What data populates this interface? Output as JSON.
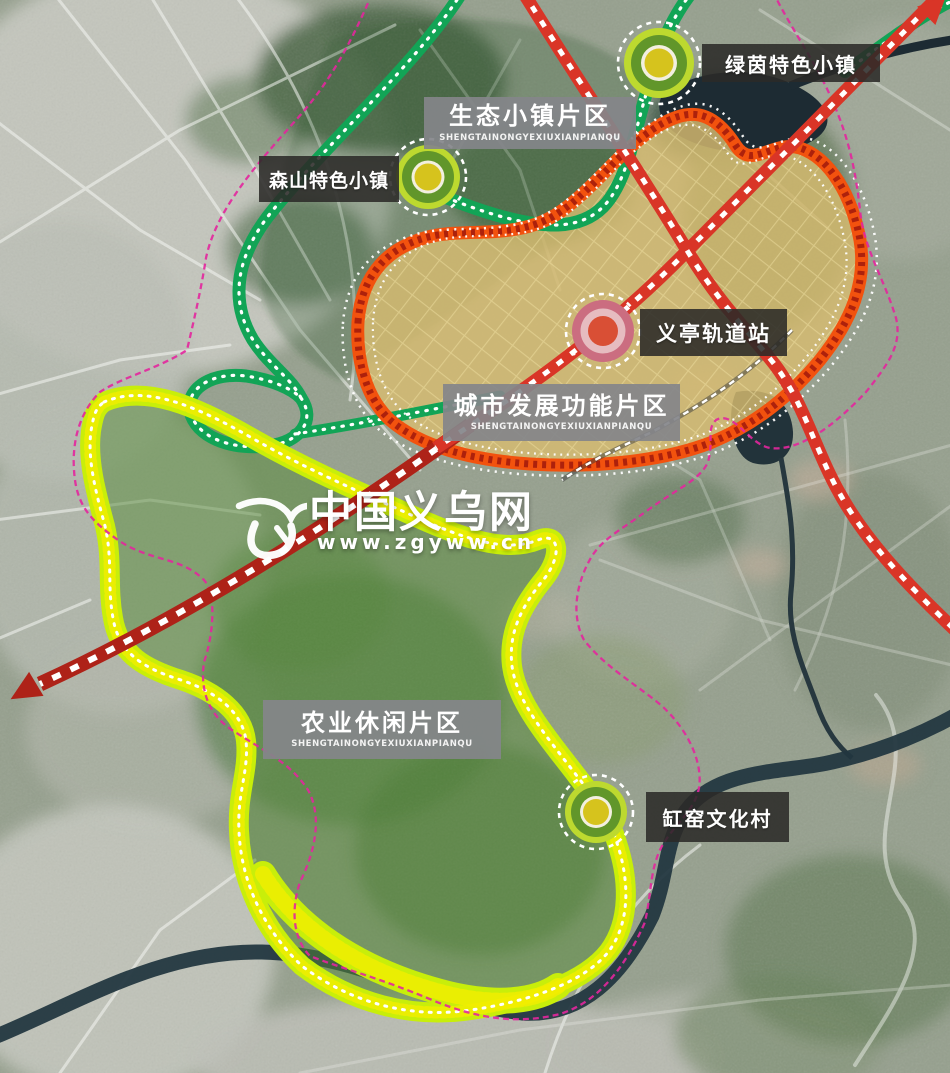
{
  "regions": [
    {
      "name": "eco-town-district",
      "label": "生态小镇片区",
      "pinyin": "SHENGTAINONGYEXIUXIANPIANQU"
    },
    {
      "name": "urban-development-district",
      "label": "城市发展功能片区",
      "pinyin": "SHENGTAINONGYEXIUXIANPIANQU"
    },
    {
      "name": "agriculture-leisure-district",
      "label": "农业休闲片区",
      "pinyin": "SHENGTAINONGYEXIUXIANPIANQU"
    }
  ],
  "markers": [
    {
      "name": "lvyin-town",
      "label": "绿茵特色小镇"
    },
    {
      "name": "senshan-town",
      "label": "森山特色小镇"
    },
    {
      "name": "yiting-rail-station",
      "label": "义亭轨道站"
    },
    {
      "name": "gangyao-village",
      "label": "缸窑文化村"
    }
  ],
  "watermark": {
    "site_name": "中国义乌网",
    "site_url": "www.zgyww.cn"
  },
  "colors": {
    "rail_red": "#d93527",
    "rail_dark_red": "#ae2218",
    "boundary_magenta": "#e3269d",
    "eco_ribbon_green": "#12a456",
    "agri_ribbon_chartreuse": "#c8ee0a",
    "agri_dot_yellow": "#f3ee00",
    "urban_ribbon_orange": "#f2520e",
    "urban_dot_dark_red": "#a51c0c",
    "urban_fill_tan": "#d8bc70",
    "marker_ring_chartreuse": "#bdd92f",
    "marker_ring_green": "#61962a",
    "marker_center_yellow": "#d6c31d",
    "station_ring_rose": "#cb6d80",
    "station_ring_pale": "#e6bcc0",
    "station_center_red": "#d94f35",
    "zone_label_bg": "rgba(132,134,138,0.92)",
    "marker_label_bg": "rgba(43,42,40,0.88)"
  }
}
